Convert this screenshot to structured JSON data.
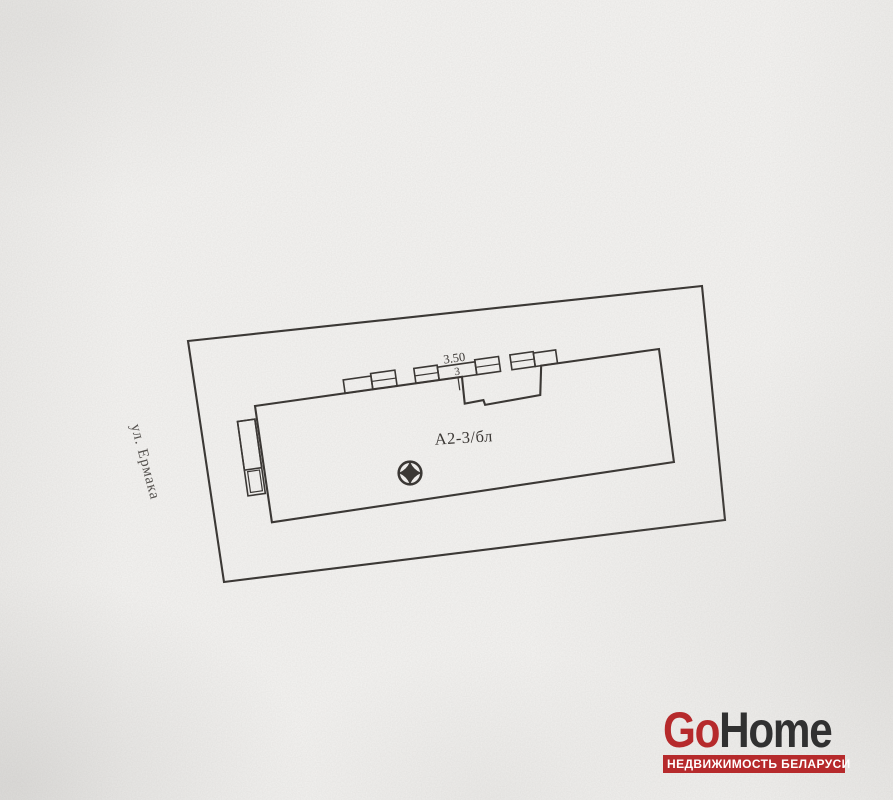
{
  "plan": {
    "street_label": "ул. Ермака",
    "building_label": "А2-3/бл",
    "dim_width": "3.50",
    "dim_depth": "3",
    "ink_color": "#3b3734",
    "symbols": {
      "survey_marker": "circled-four-point-star"
    }
  },
  "watermark": {
    "brand_prefix": "Go",
    "brand_suffix": "Home",
    "tagline": "НЕДВИЖИМОСТЬ БЕЛАРУСИ",
    "accent_color": "#b62a2c",
    "dark_color": "#313131"
  }
}
